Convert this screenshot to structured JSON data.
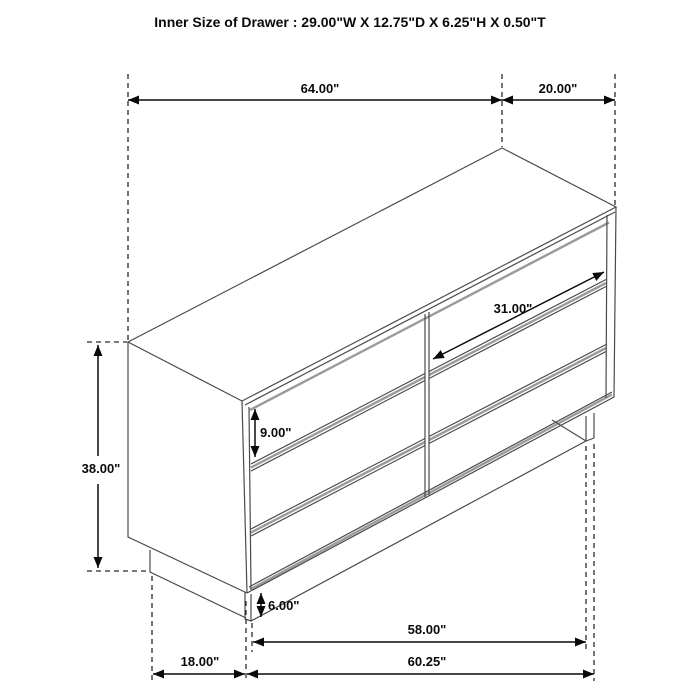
{
  "title": "Inner Size of Drawer : 29.00\"W X 12.75\"D X 6.25\"H X 0.50\"T",
  "dimensions": {
    "top_width": "64.00\"",
    "top_depth": "20.00\"",
    "overall_height": "38.00\"",
    "drawer_front_height": "9.00\"",
    "drawer_front_width": "31.00\"",
    "base_height": "6.00\"",
    "base_front_width": "58.00\"",
    "side_floor_depth": "18.00\"",
    "front_floor_width": "60.25\""
  },
  "colors": {
    "background": "#ffffff",
    "drawing_line": "#4a4a4a",
    "bevel_gray": "#9a9a9a",
    "dimension_line": "#0a0a0a",
    "text": "#0a0a0a"
  }
}
